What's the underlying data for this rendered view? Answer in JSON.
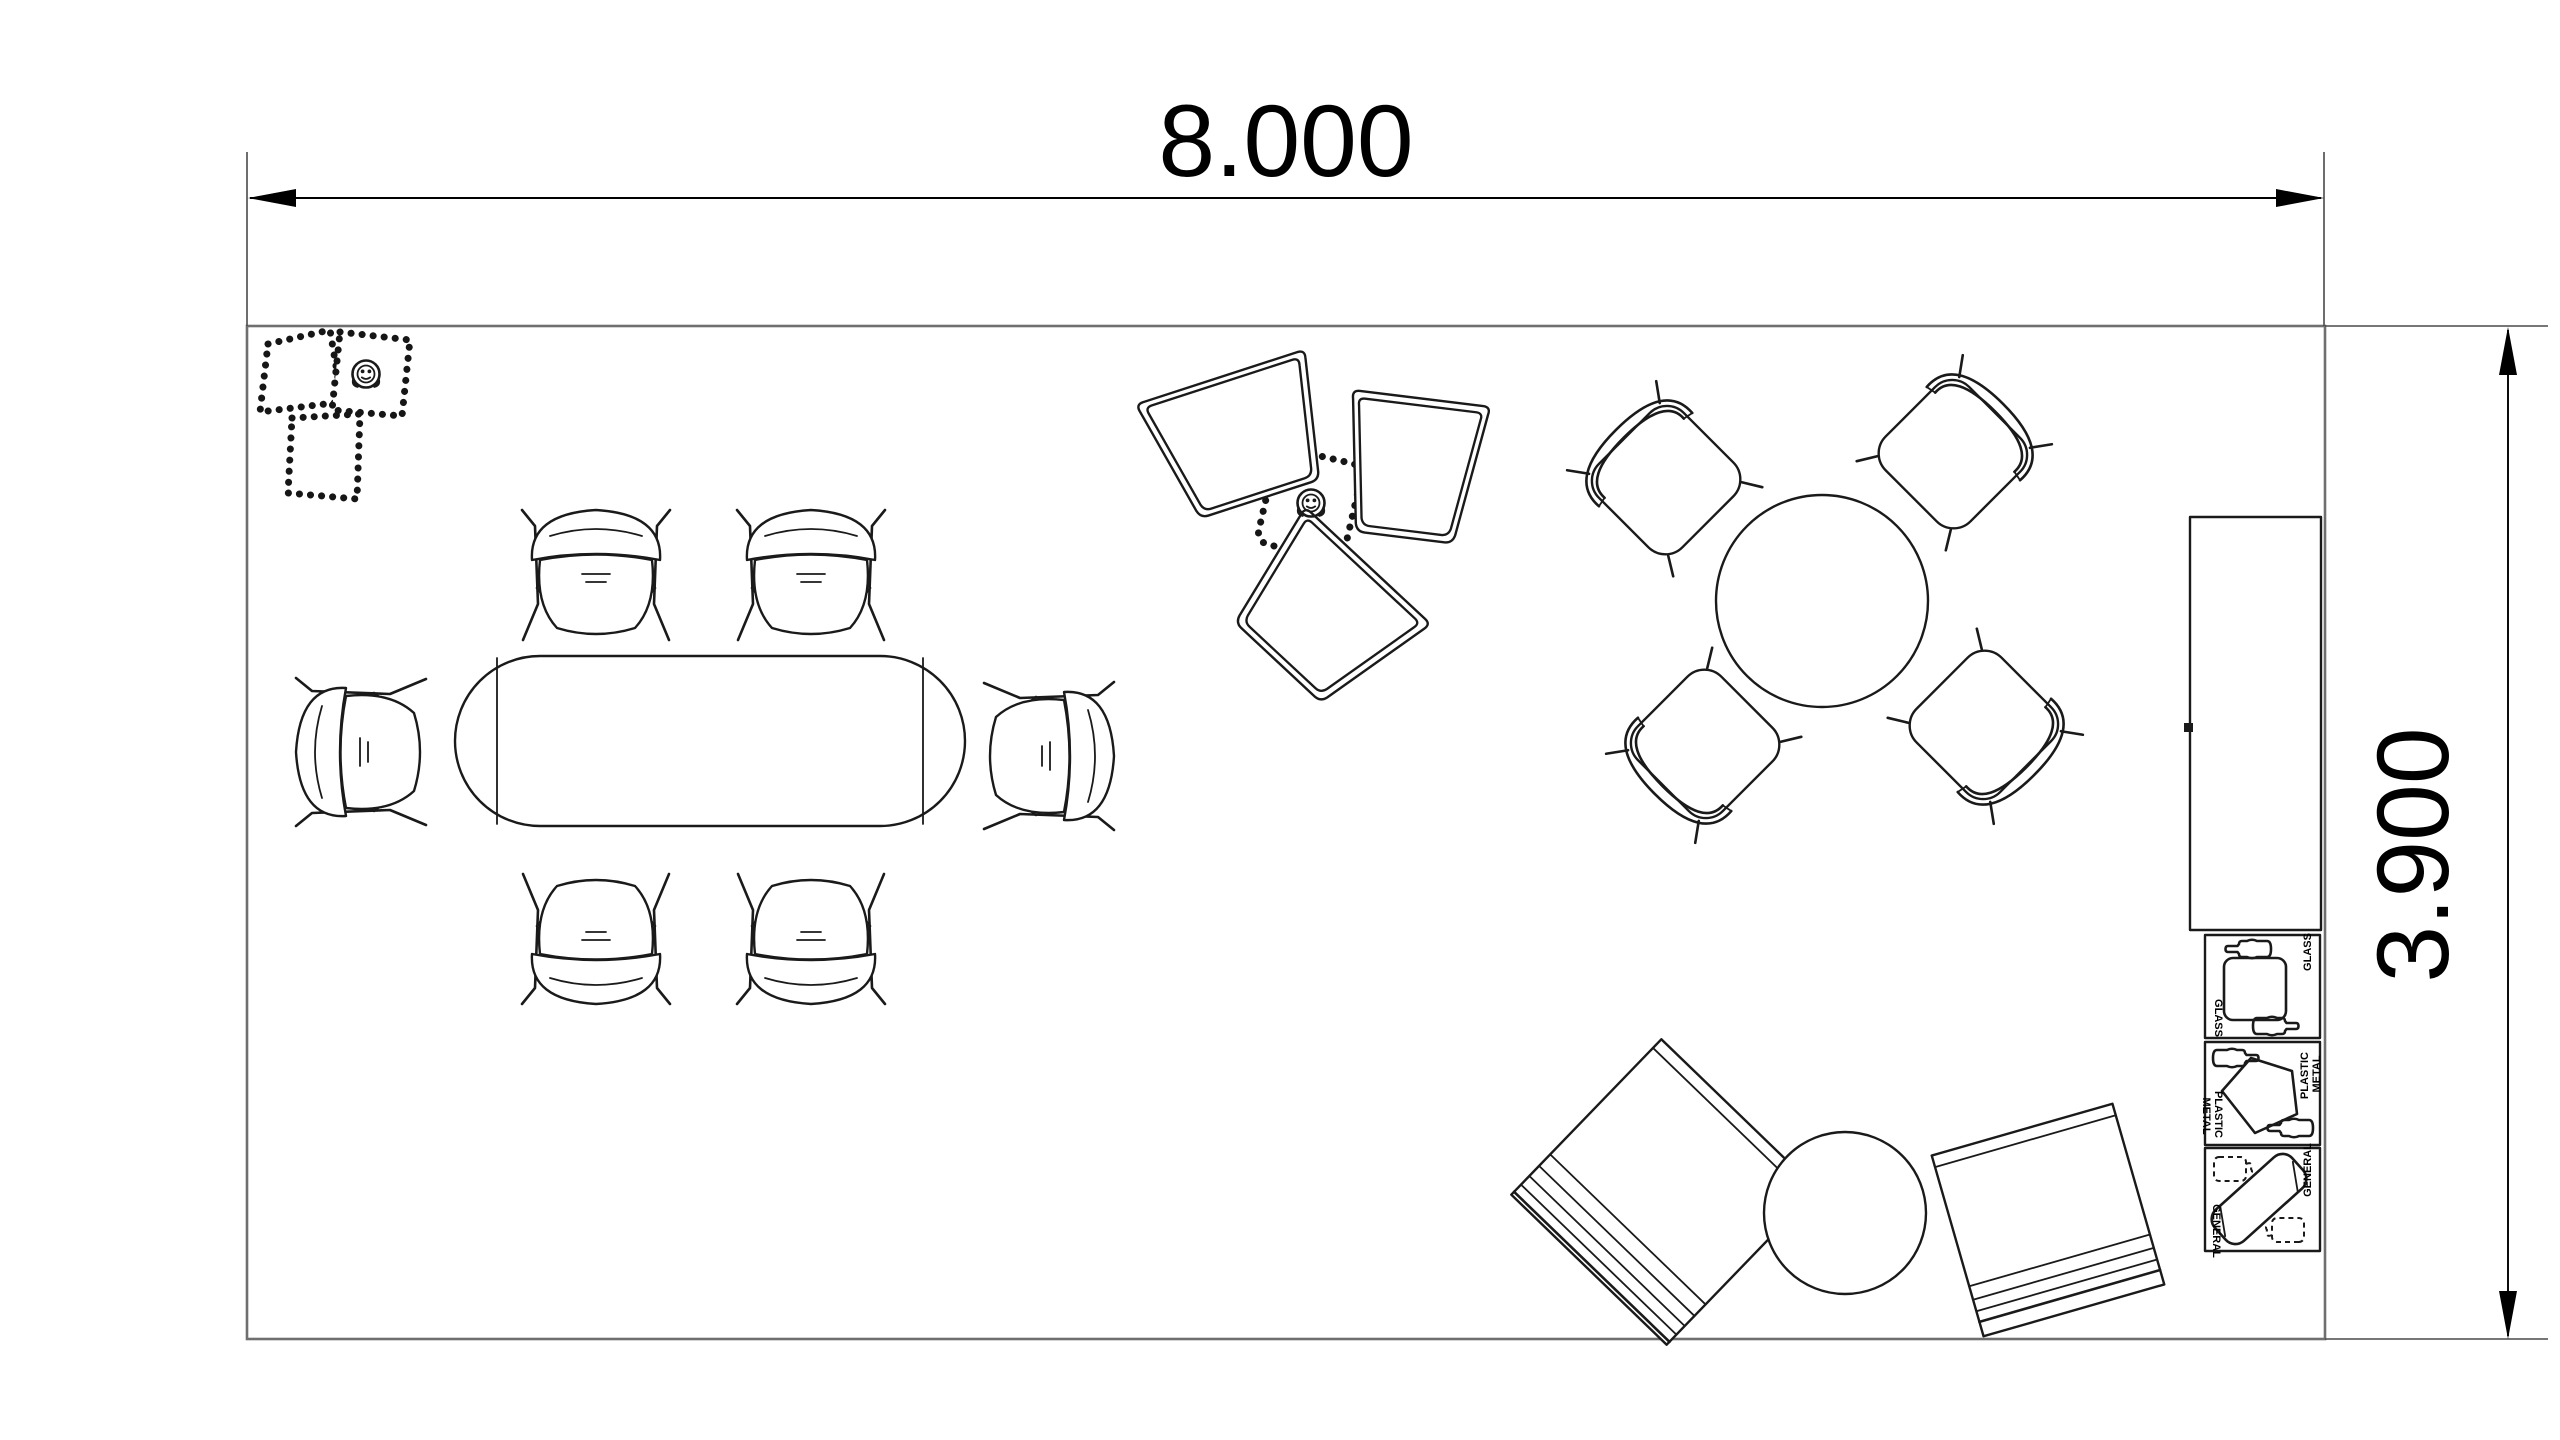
{
  "drawing": {
    "type": "office-floor-plan",
    "background": "#ffffff"
  },
  "dimensions": {
    "horizontal": "8.000",
    "vertical": "3.900"
  },
  "recycling_station": {
    "bins": [
      {
        "label": "GLASS"
      },
      {
        "label_line1": "PLASTIC",
        "label_line2": "METAL"
      },
      {
        "label": "GENERAL"
      }
    ]
  },
  "furniture_inventory": {
    "oval_conference_table": 1,
    "conference_chairs": 6,
    "round_meeting_table": 1,
    "meeting_chairs": 4,
    "collaboration_tables": 3,
    "beaded_poufs": 4,
    "floor_sockets": 2,
    "lounge_mats": 2,
    "round_coffee_table": 1,
    "storage_cabinet": 1,
    "recycling_bins": 3
  },
  "colors": {
    "background": "#ffffff",
    "wall": "#6f6f6f",
    "furniture_line": "#1a1a1a",
    "dimension_line": "#000000"
  }
}
